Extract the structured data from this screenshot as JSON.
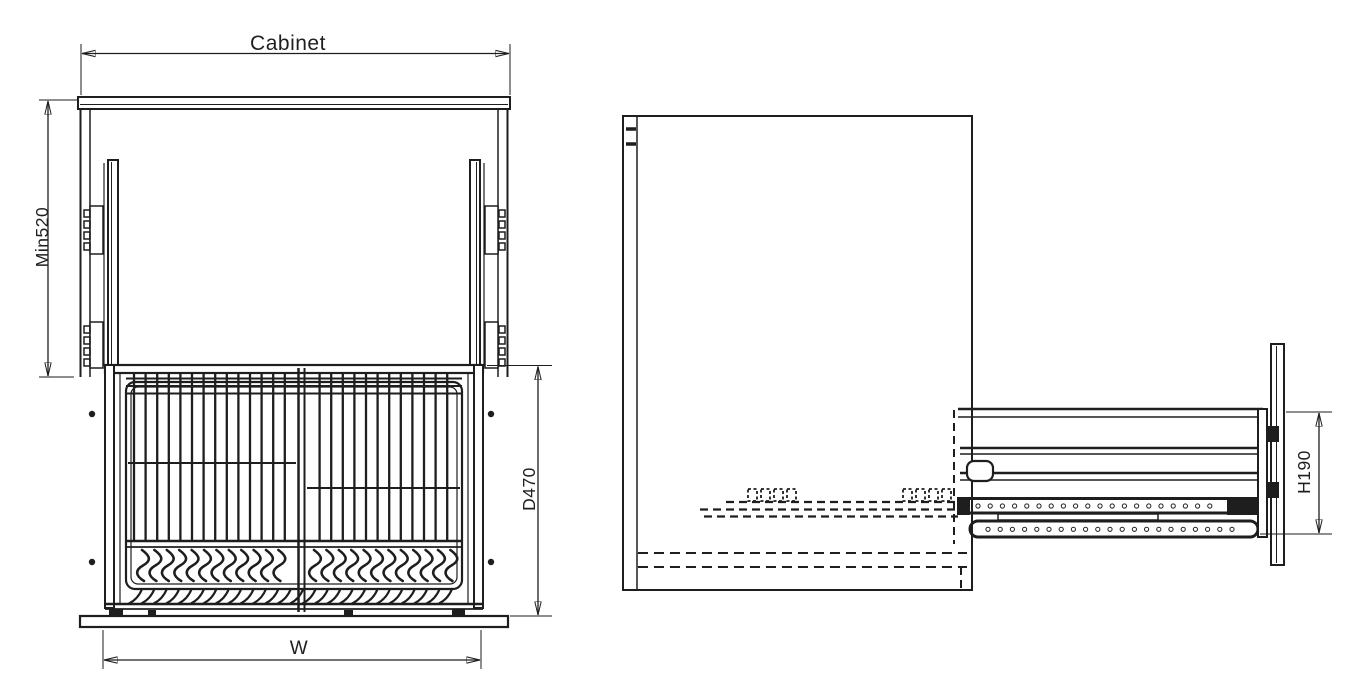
{
  "meta": {
    "drawing_type": "cabinet pull-out dish rack technical drawing",
    "line_color": "#1e1e1e",
    "background_color": "#ffffff"
  },
  "front_view": {
    "dimensions": {
      "cabinet_label": "Cabinet",
      "min520_label": "Min520",
      "d470_label": "D470",
      "w_label": "W"
    }
  },
  "side_view": {
    "dimensions": {
      "h190_label": "H190"
    }
  }
}
